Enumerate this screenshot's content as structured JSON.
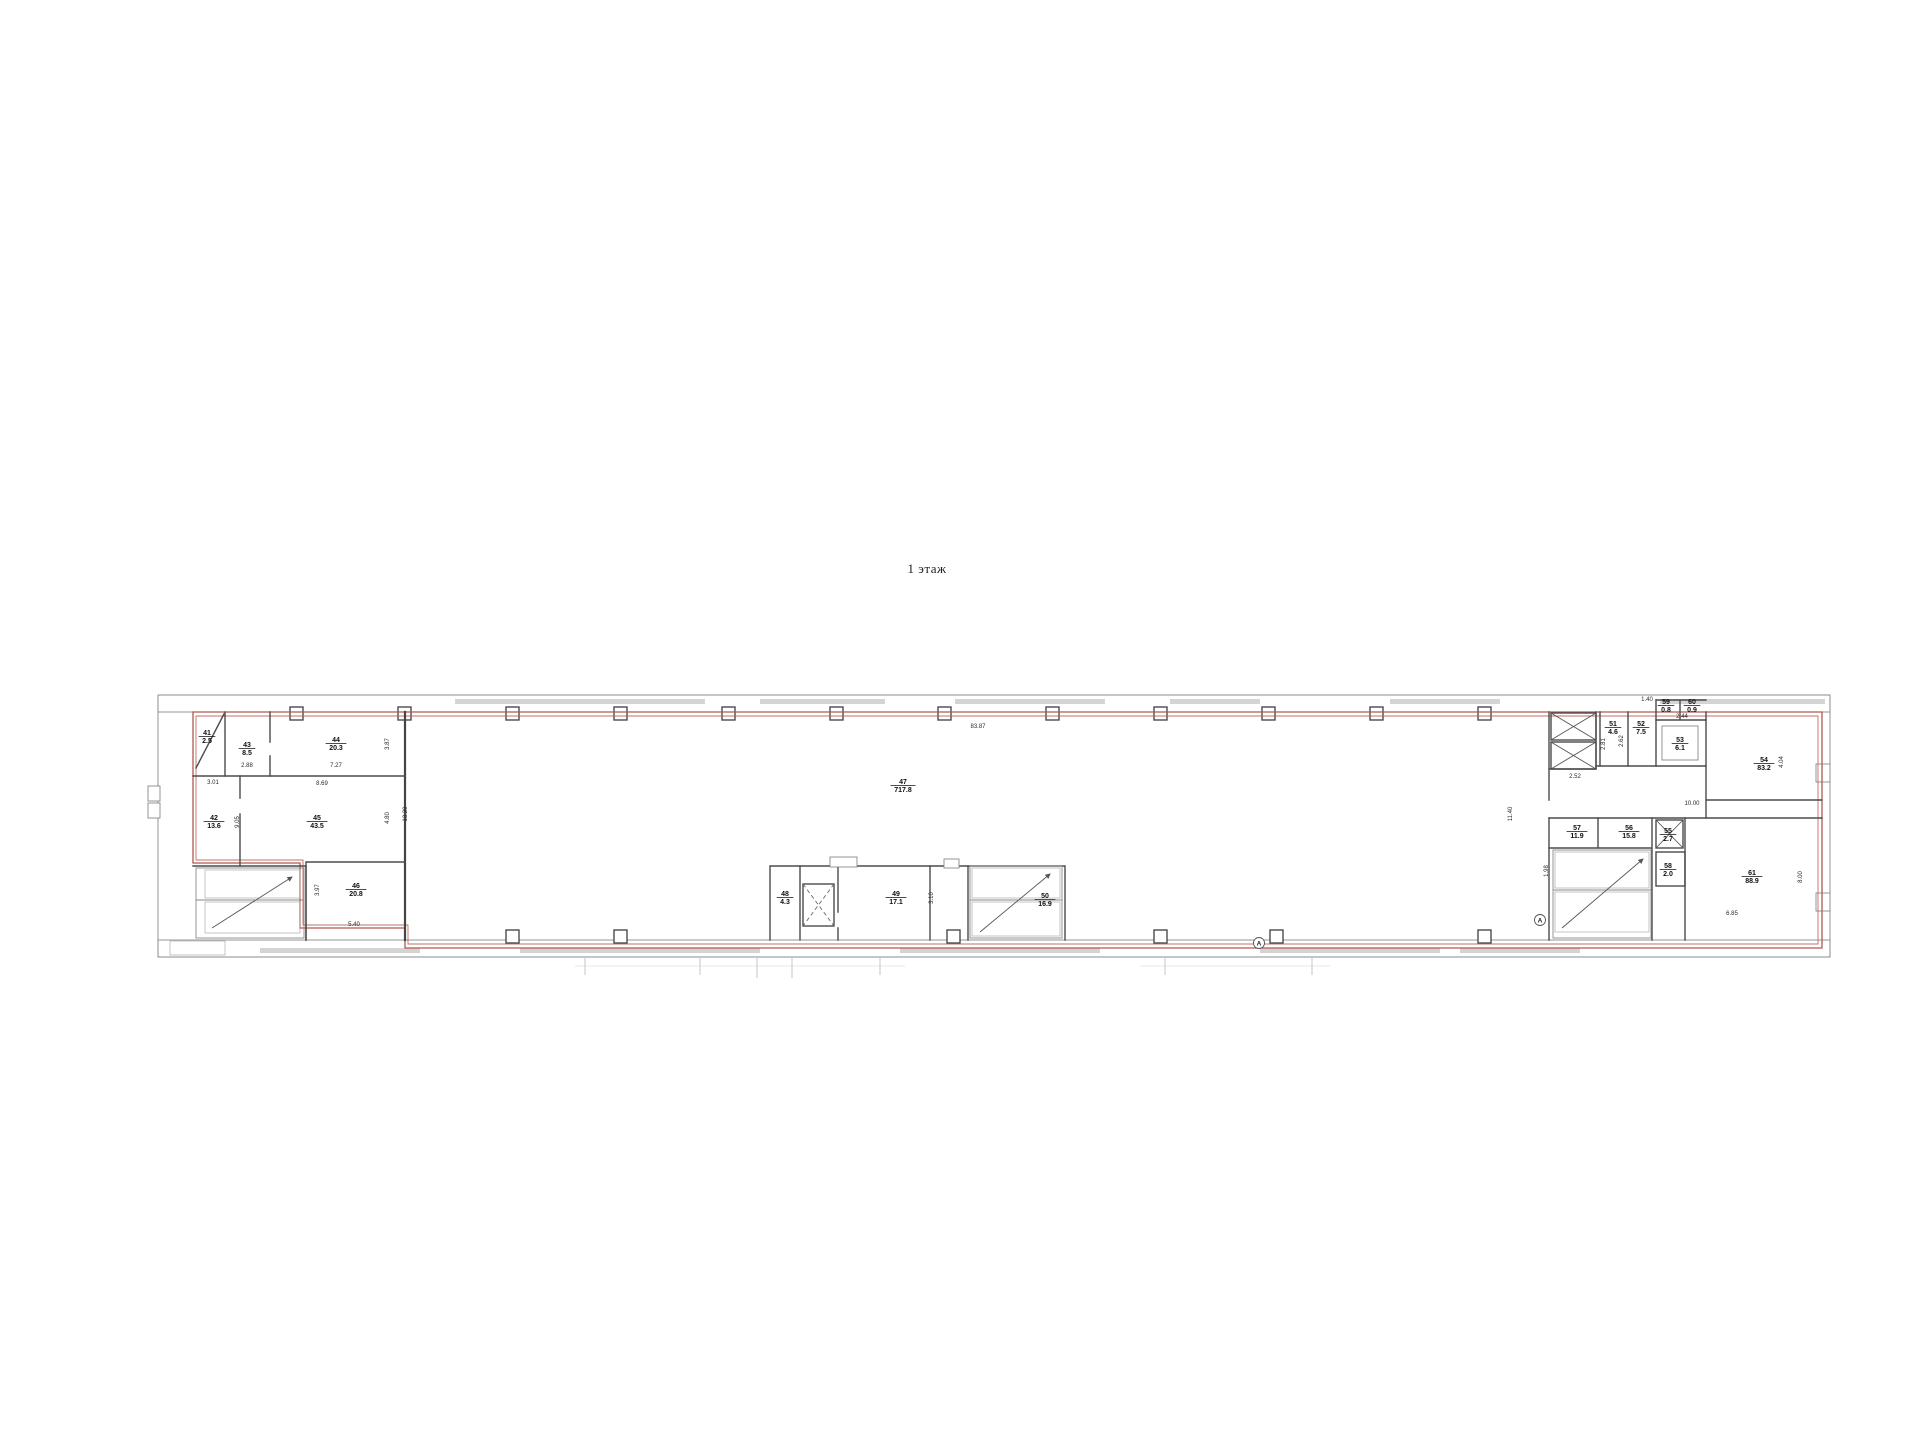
{
  "title": "1 этаж",
  "colors": {
    "accent_red": "#b4584e",
    "wall_gray": "#4b4b4b"
  },
  "plan": {
    "rooms": [
      {
        "id": "41",
        "area": "2.5",
        "x": 207,
        "y": 735
      },
      {
        "id": "43",
        "area": "8.5",
        "x": 247,
        "y": 747
      },
      {
        "id": "44",
        "area": "20.3",
        "x": 336,
        "y": 742
      },
      {
        "id": "42",
        "area": "13.6",
        "x": 214,
        "y": 820
      },
      {
        "id": "45",
        "area": "43.5",
        "x": 317,
        "y": 820
      },
      {
        "id": "46",
        "area": "20.8",
        "x": 356,
        "y": 888
      },
      {
        "id": "47",
        "area": "717.8",
        "x": 903,
        "y": 784
      },
      {
        "id": "48",
        "area": "4.3",
        "x": 785,
        "y": 896
      },
      {
        "id": "49",
        "area": "17.1",
        "x": 896,
        "y": 896
      },
      {
        "id": "50",
        "area": "16.9",
        "x": 1045,
        "y": 898
      },
      {
        "id": "51",
        "area": "4.6",
        "x": 1613,
        "y": 726
      },
      {
        "id": "52",
        "area": "7.5",
        "x": 1641,
        "y": 726
      },
      {
        "id": "53",
        "area": "6.1",
        "x": 1680,
        "y": 742
      },
      {
        "id": "59",
        "area": "0.8",
        "x": 1666,
        "y": 704
      },
      {
        "id": "60",
        "area": "0.9",
        "x": 1692,
        "y": 704
      },
      {
        "id": "54",
        "area": "83.2",
        "x": 1764,
        "y": 762
      },
      {
        "id": "57",
        "area": "11.9",
        "x": 1577,
        "y": 830
      },
      {
        "id": "56",
        "area": "15.8",
        "x": 1629,
        "y": 830
      },
      {
        "id": "55",
        "area": "2.7",
        "x": 1668,
        "y": 833
      },
      {
        "id": "58",
        "area": "2.0",
        "x": 1668,
        "y": 868
      },
      {
        "id": "61",
        "area": "88.9",
        "x": 1752,
        "y": 875
      }
    ],
    "dimensions": [
      {
        "text": "83.87",
        "x": 978,
        "y": 728
      },
      {
        "text": "2.88",
        "x": 247,
        "y": 767
      },
      {
        "text": "7.27",
        "x": 336,
        "y": 767
      },
      {
        "text": "3.01",
        "x": 213,
        "y": 784
      },
      {
        "text": "8.69",
        "x": 322,
        "y": 785
      },
      {
        "text": "3.87",
        "x": 389,
        "y": 744,
        "rot": true
      },
      {
        "text": "9.05",
        "x": 239,
        "y": 822,
        "rot": true
      },
      {
        "text": "4.80",
        "x": 389,
        "y": 818,
        "rot": true
      },
      {
        "text": "13.20",
        "x": 407,
        "y": 814,
        "rot": true
      },
      {
        "text": "3.97",
        "x": 319,
        "y": 890,
        "rot": true
      },
      {
        "text": "5.40",
        "x": 354,
        "y": 926
      },
      {
        "text": "3.10",
        "x": 933,
        "y": 898,
        "rot": true
      },
      {
        "text": "11.40",
        "x": 1512,
        "y": 814,
        "rot": true
      },
      {
        "text": "2.81",
        "x": 1605,
        "y": 744,
        "rot": true
      },
      {
        "text": "2.62",
        "x": 1623,
        "y": 741,
        "rot": true
      },
      {
        "text": "2.52",
        "x": 1575,
        "y": 778
      },
      {
        "text": "1.40",
        "x": 1647,
        "y": 701
      },
      {
        "text": "2.44",
        "x": 1682,
        "y": 718
      },
      {
        "text": "10.00",
        "x": 1692,
        "y": 805
      },
      {
        "text": "4.04",
        "x": 1783,
        "y": 762,
        "rot": true
      },
      {
        "text": "8.00",
        "x": 1802,
        "y": 877,
        "rot": true
      },
      {
        "text": "6.85",
        "x": 1732,
        "y": 915
      },
      {
        "text": "1.98",
        "x": 1548,
        "y": 871,
        "rot": true
      }
    ],
    "axis_marks": [
      {
        "text": "А",
        "x": 1259,
        "y": 943
      },
      {
        "text": "А",
        "x": 1540,
        "y": 920
      }
    ]
  }
}
